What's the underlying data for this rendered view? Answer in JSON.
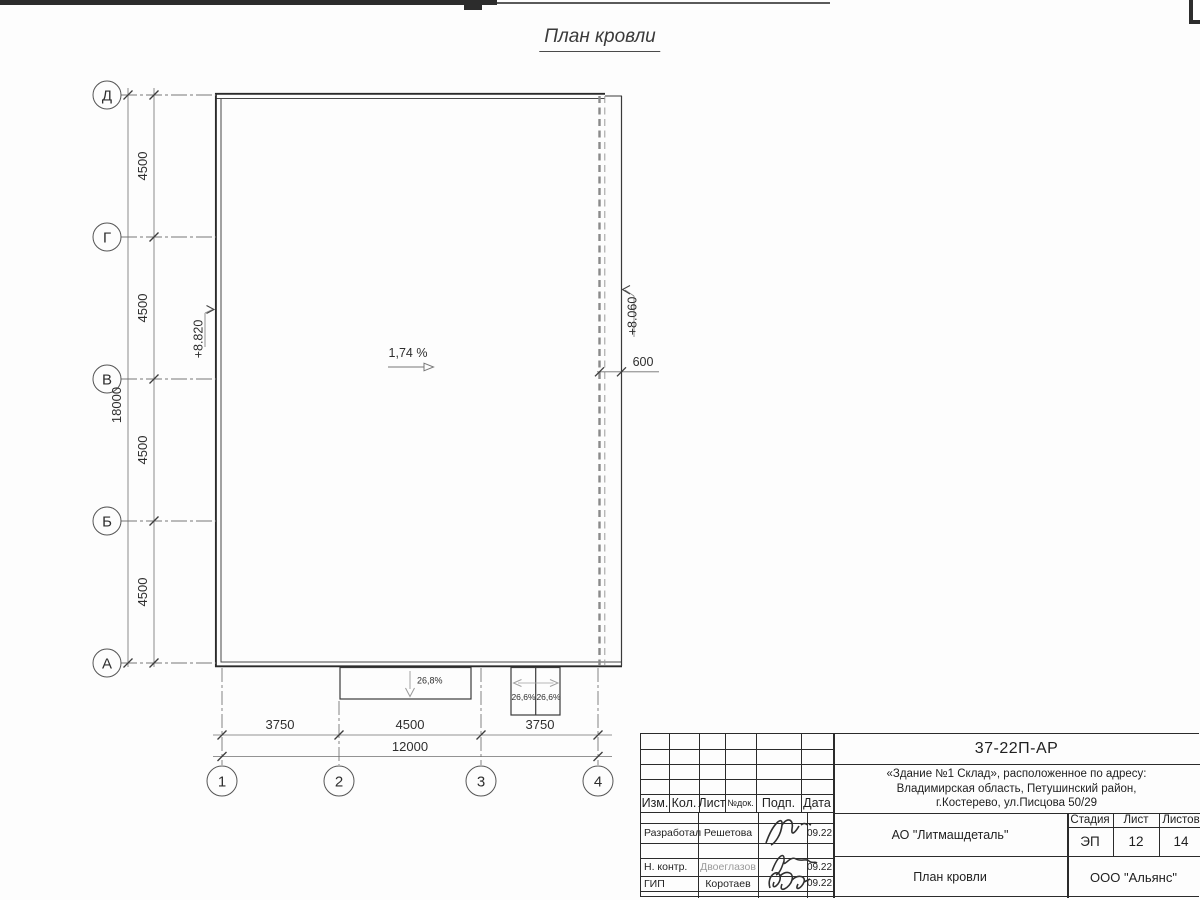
{
  "sheet": {
    "title": "План кровли"
  },
  "plan": {
    "row_axes": [
      "Д",
      "Г",
      "В",
      "Б",
      "А"
    ],
    "row_dims": [
      "4500",
      "4500",
      "4500",
      "4500"
    ],
    "row_total": "18000",
    "col_axes": [
      "1",
      "2",
      "3",
      "4"
    ],
    "col_dims": [
      "3750",
      "4500",
      "3750"
    ],
    "col_total": "12000",
    "offset_dim": "600",
    "elevation_left": "+8.820",
    "elevation_right": "+8.060",
    "slope_main": "1,74 %",
    "canopy_slope_wide": "26,8%",
    "canopy_slope_left": "26,6%",
    "canopy_slope_right": "26,6%"
  },
  "titleblock": {
    "doc_number": "37-22П-АР",
    "address_line1": "«Здание №1 Склад», расположенное по адресу:",
    "address_line2": "Владимирская область, Петушинский район,",
    "address_line3": "г.Костерево, ул.Писцова 50/29",
    "header_cols": {
      "izm": "Изм.",
      "kol": "Кол.",
      "list": "Лист",
      "ndok": "№док.",
      "podp": "Подп.",
      "data": "Дата"
    },
    "rows": [
      {
        "role": "Разработал",
        "name": "Решетова",
        "date": "09.22"
      },
      {
        "role": "Н. контр.",
        "name": "Двоеглазов",
        "date": "09.22"
      },
      {
        "role": "ГИП",
        "name": "Коротаев",
        "date": "09.22"
      }
    ],
    "company": "АО \"Литмашдеталь\"",
    "stage_label": "Стадия",
    "sheet_label": "Лист",
    "sheets_label": "Листов",
    "stage": "ЭП",
    "sheet_num": "12",
    "sheets_total": "14",
    "sheet_name": "План кровли",
    "org": "ООО \"Альянс\""
  }
}
